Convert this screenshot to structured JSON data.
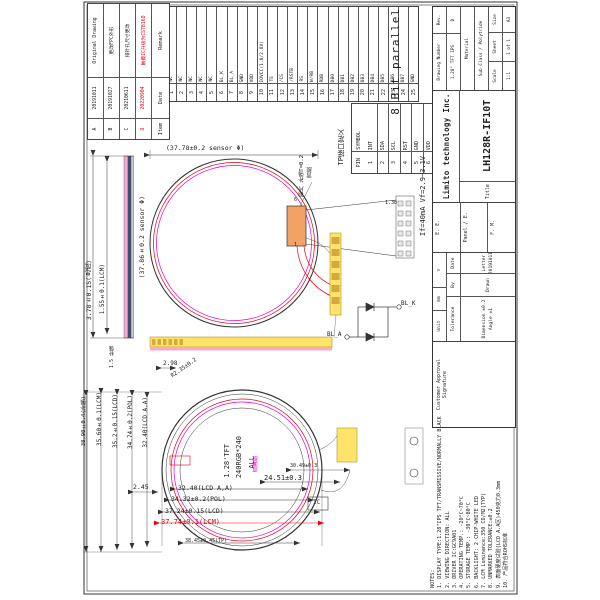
{
  "doc": {
    "model": "LH128R-IF10T",
    "company": "Limito technology Inc."
  },
  "rev_table": {
    "headers": [
      "Item",
      "Date",
      "Remark"
    ],
    "rows": [
      {
        "item": "A",
        "date": "20191011",
        "remark": "Original Drawing",
        "red": false
      },
      {
        "item": "B",
        "date": "20191027",
        "remark": "更改FPC外形",
        "red": false
      },
      {
        "item": "C",
        "date": "20210611",
        "remark": "排针孔尺寸更改",
        "red": false
      },
      {
        "item": "D",
        "date": "20220904",
        "remark": "触摸IC升级为CST816D",
        "red": true
      }
    ]
  },
  "pin_table": {
    "pin_label": "PIN",
    "desc_label": "DESCRIPTION",
    "pins": [
      {
        "no": "1",
        "desc": "NC"
      },
      {
        "no": "2",
        "desc": "NC"
      },
      {
        "no": "3",
        "desc": "NC"
      },
      {
        "no": "4",
        "desc": "NC"
      },
      {
        "no": "5",
        "desc": "NC"
      },
      {
        "no": "6",
        "desc": "BL_K"
      },
      {
        "no": "7",
        "desc": "BL_A"
      },
      {
        "no": "8",
        "desc": "GND"
      },
      {
        "no": "9",
        "desc": "VDD"
      },
      {
        "no": "10",
        "desc": "IOVCC(1.8/2.8V)"
      },
      {
        "no": "11",
        "desc": "TE"
      },
      {
        "no": "12",
        "desc": "/CS"
      },
      {
        "no": "13",
        "desc": "/RSTB"
      },
      {
        "no": "14",
        "desc": "RS"
      },
      {
        "no": "15",
        "desc": "W/RB"
      },
      {
        "no": "16",
        "desc": "RDB"
      },
      {
        "no": "17",
        "desc": "DB0"
      },
      {
        "no": "18",
        "desc": "DB1"
      },
      {
        "no": "19",
        "desc": "DB2"
      },
      {
        "no": "20",
        "desc": "DB3"
      },
      {
        "no": "21",
        "desc": "DB4"
      },
      {
        "no": "22",
        "desc": "DB5"
      },
      {
        "no": "23",
        "desc": "DB6"
      },
      {
        "no": "24",
        "desc": "DB7"
      },
      {
        "no": "25",
        "desc": "GND"
      }
    ]
  },
  "tp_table": {
    "title": "TP接口定义",
    "pin_label": "PIN",
    "symbol_label": "SYMBOL",
    "pins": [
      {
        "no": "1",
        "sym": "INT"
      },
      {
        "no": "2",
        "sym": "SDA"
      },
      {
        "no": "3",
        "sym": "SCL"
      },
      {
        "no": "4",
        "sym": "RST"
      },
      {
        "no": "5",
        "sym": "GND"
      },
      {
        "no": "6",
        "sym": "VDD"
      }
    ]
  },
  "title_block": {
    "customer_approval": "Customer Approval Signature",
    "unit_label": "Unit",
    "unit": "mm",
    "roughness_label": "General Roughness",
    "roughness_symbol": "▽",
    "tolerance_label": "Tolerance",
    "by_label": "By",
    "date_label": "Date",
    "dim_label": "Dimension",
    "dim_tol": "±0.2",
    "angle_label": "Angle",
    "angle_tol": "±1",
    "drawn_label": "Drawn",
    "drawn_by": "Letter",
    "drawn_date": "20191011",
    "approvals": [
      "E. E.",
      "Panel / E.",
      "F. M."
    ],
    "company": "Limito technology Inc.",
    "title_label": "Title",
    "model": "LH128R-IF10T",
    "drawing_number_label": "Drawing Number",
    "drawing_number": "1.28\" TFT IPS",
    "rev_label": "Rev.",
    "rev": "D",
    "material_label": "Material",
    "sub_class": "Sub Class / Polytride",
    "scale_label": "Scale",
    "scale": "1:1",
    "sheet_label": "Sheet",
    "sheet": "1 of 1",
    "size_label": "Size",
    "size": "A3"
  },
  "notes": {
    "lines": [
      "NOTES:",
      "1. DISPLAY TYPE:1.28\"IPS TFT/TRANSMISSIVE/NORMALLY BLACK",
      "2. VIEWING DIRECTION: ALL",
      "3. DRIVER IC:GC9A01",
      "4. OPERATING TEMP.: -20°C~70°C",
      "5. STORAGE TEMP.: -30°C~80°C",
      "6. BACKLIGHT: 2 CHIP-WHITE LED",
      "7. LCM Luminance:350 CD/M2(TYP)",
      "8. UNMARKED TOLERANCE:±0.2",
      "9. 表面硬度试验(LCD A.A区)450克力0.3mm",
      "10. 产品符合ROHS标准"
    ]
  },
  "bus_label": "8 Bit parallel",
  "annotations": [
    {
      "t": "(37.78±0.2 sensor Φ)",
      "x": 166,
      "y": 145,
      "o": "h",
      "s": 6.5
    },
    {
      "t": "(37.86±0.2 sensor Φ)",
      "x": 139,
      "y": 196,
      "o": "v",
      "s": 6.5
    },
    {
      "t": "3.78±0.15(总成)",
      "x": 86,
      "y": 260,
      "o": "v",
      "s": 6.5
    },
    {
      "t": "1.55±0.1(LCM)",
      "x": 100,
      "y": 264,
      "o": "v",
      "s": 6
    },
    {
      "t": "钢片 补强T=0.2",
      "x": 300,
      "y": 155,
      "o": "v",
      "s": 5.5
    },
    {
      "t": "背胶",
      "x": 308,
      "y": 167,
      "o": "v",
      "s": 5.5
    },
    {
      "t": "6",
      "x": 294,
      "y": 198,
      "o": "h",
      "s": 5
    },
    {
      "t": "1",
      "x": 294,
      "y": 243,
      "o": "h",
      "s": 5
    },
    {
      "t": "1.30",
      "x": 385,
      "y": 201,
      "o": "h",
      "s": 5
    },
    {
      "t": "If=40mA  Vf=2.9~3.1V",
      "x": 420,
      "y": 156,
      "o": "v",
      "s": 7
    },
    {
      "t": "BL_A",
      "x": 327,
      "y": 332,
      "o": "h",
      "s": 6
    },
    {
      "t": "BL_K",
      "x": 401,
      "y": 301,
      "o": "h",
      "s": 6
    },
    {
      "t": "TP接口定义",
      "x": 338,
      "y": 129,
      "o": "v",
      "s": 7
    },
    {
      "t": "38.90±0.4(补强)",
      "x": 82,
      "y": 396,
      "o": "v",
      "s": 5.5
    },
    {
      "t": "35.60±0.1(LCM)",
      "x": 97,
      "y": 392,
      "o": "v",
      "s": 6
    },
    {
      "t": "35.2±0.15(LCD)",
      "x": 113,
      "y": 394,
      "o": "v",
      "s": 6
    },
    {
      "t": "34.74±0.2(POL)",
      "x": 128,
      "y": 395,
      "o": "v",
      "s": 6
    },
    {
      "t": "32.40(LCD A.A)",
      "x": 143,
      "y": 397,
      "o": "v",
      "s": 6
    },
    {
      "t": "1.5 补强",
      "x": 110,
      "y": 346,
      "o": "v",
      "s": 5
    },
    {
      "t": "2.98",
      "x": 163,
      "y": 361,
      "o": "h",
      "s": 6
    },
    {
      "t": "2.45",
      "x": 133,
      "y": 484,
      "o": "h",
      "s": 6.5
    },
    {
      "t": "32.40(LCD A,A)",
      "x": 178,
      "y": 485,
      "o": "h",
      "s": 6.5
    },
    {
      "t": "34.32±0.2(POL)",
      "x": 171,
      "y": 496,
      "o": "h",
      "s": 6.5
    },
    {
      "t": "37.24±0.15(LCD)",
      "x": 165,
      "y": 508,
      "o": "h",
      "s": 6.5
    },
    {
      "t": "37.74±0.1(LCM)",
      "x": 161,
      "y": 519,
      "o": "h",
      "s": 7,
      "c": "red"
    },
    {
      "t": "38.45±0.45(TP)",
      "x": 185,
      "y": 539,
      "o": "h",
      "s": 5
    },
    {
      "t": "30.49±0.3",
      "x": 290,
      "y": 464,
      "o": "h",
      "s": 5
    },
    {
      "t": "24.51±0.3",
      "x": 264,
      "y": 475,
      "o": "h",
      "s": 7
    },
    {
      "t": "IC",
      "x": 313,
      "y": 500,
      "o": "h",
      "s": 6
    },
    {
      "t": "双面胶",
      "x": 254,
      "y": 456,
      "o": "v",
      "s": 5.5,
      "c": "magenta"
    },
    {
      "t": "R2.35±0.2",
      "x": 174,
      "y": 374,
      "o": "h",
      "s": 5.5,
      "r": -35
    },
    {
      "t": "1.28'TFT",
      "x": 224,
      "y": 444,
      "o": "v",
      "s": 7
    },
    {
      "t": "240RGB*240",
      "x": 236,
      "y": 436,
      "o": "v",
      "s": 7
    },
    {
      "t": "ALL",
      "x": 249,
      "y": 456,
      "o": "v",
      "s": 7
    }
  ],
  "colors": {
    "line": "#333333",
    "red": "#e60012",
    "magenta": "#e800c8",
    "yellow": "#ffe469",
    "gold": "#d4aa3c",
    "orange": "#f2a264",
    "pink": "#f6a8d0"
  }
}
